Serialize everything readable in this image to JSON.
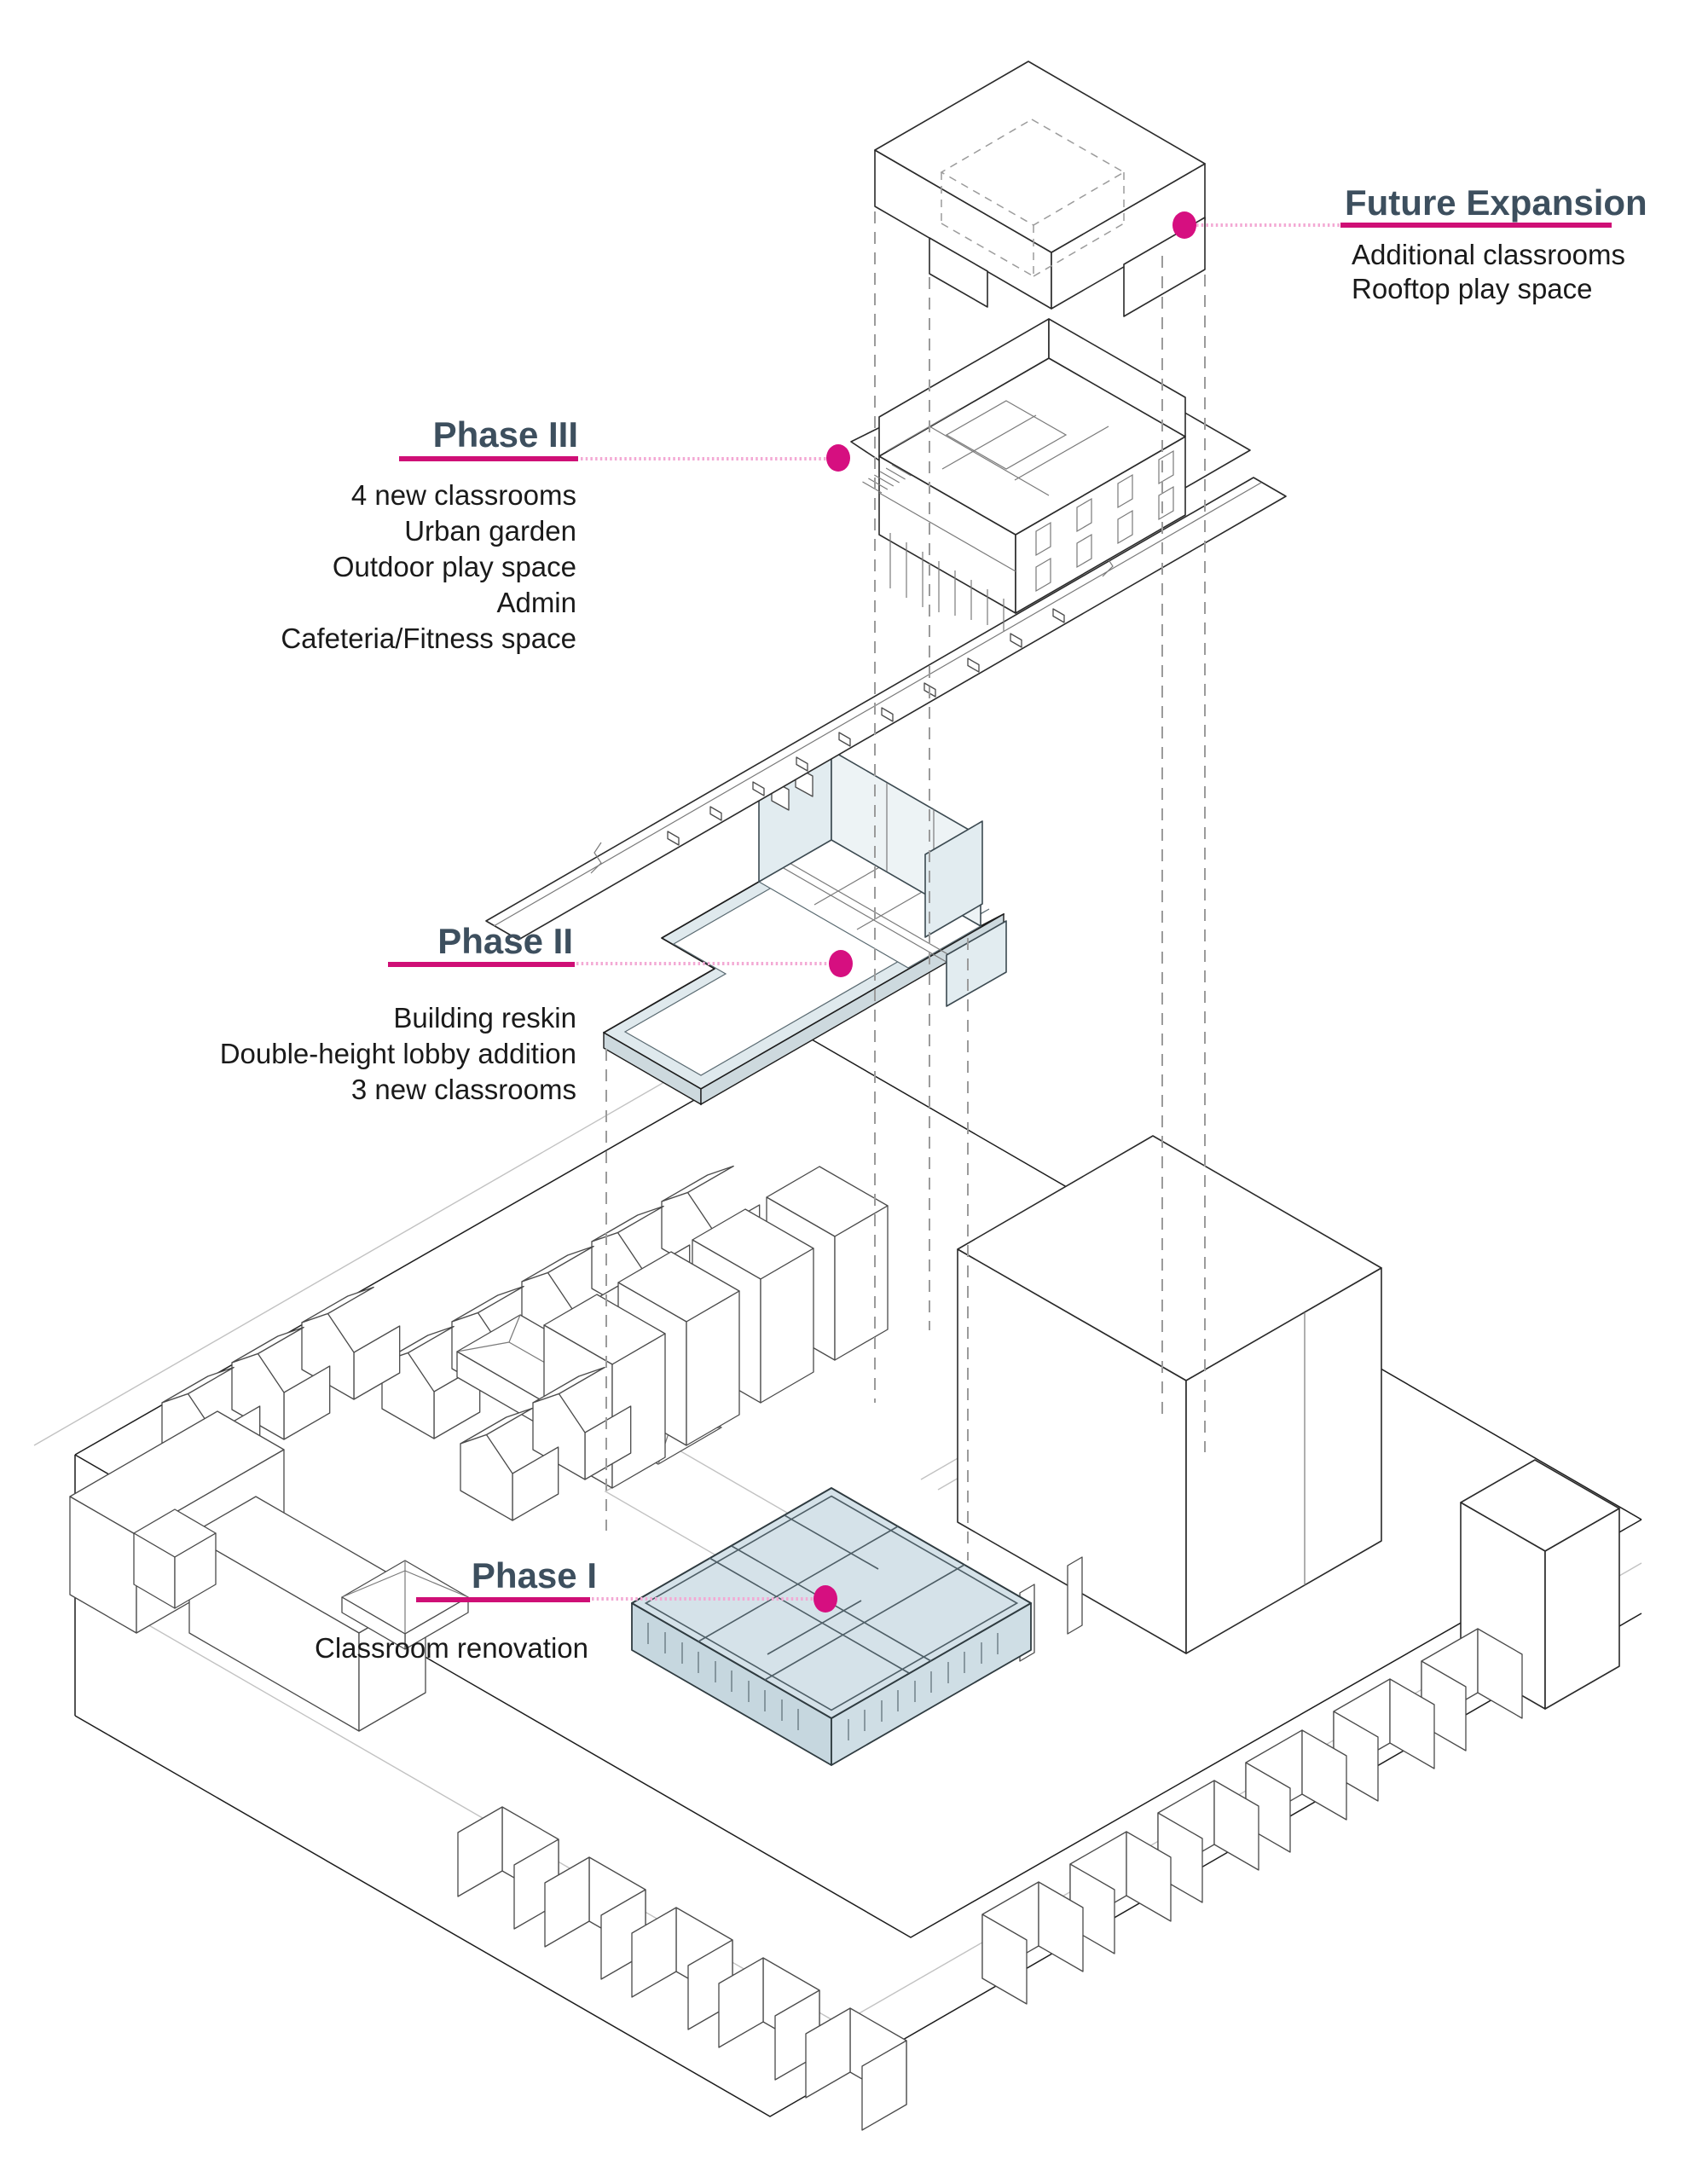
{
  "diagram_title": "School expansion phasing axonometric",
  "labels": {
    "future_expansion": {
      "title": "Future Expansion",
      "lines": [
        "Additional classrooms",
        "Rooftop play space"
      ]
    },
    "phase3": {
      "title": "Phase III",
      "lines": [
        "4 new classrooms",
        "Urban garden",
        "Outdoor play space",
        "Admin",
        "Cafeteria/Fitness space"
      ]
    },
    "phase2": {
      "title": "Phase II",
      "lines": [
        "Building reskin",
        "Double-height lobby addition",
        "3 new classrooms"
      ]
    },
    "phase1": {
      "title": "Phase I",
      "lines": [
        "Classroom renovation"
      ]
    }
  },
  "icons": {
    "leader_dot": "filled-circle-marker"
  },
  "colors": {
    "heading": "#3d4f5e",
    "underline_solid": "#cf0f76",
    "leader_dotted": "#f3a9d4",
    "marker_dot": "#d60f80",
    "phase1_highlight": "#d5e2e9",
    "wall_blue": "#e2ecf0",
    "line": "#1c1c1c",
    "hidden_line": "#9b9b9b",
    "background": "#ffffff"
  }
}
